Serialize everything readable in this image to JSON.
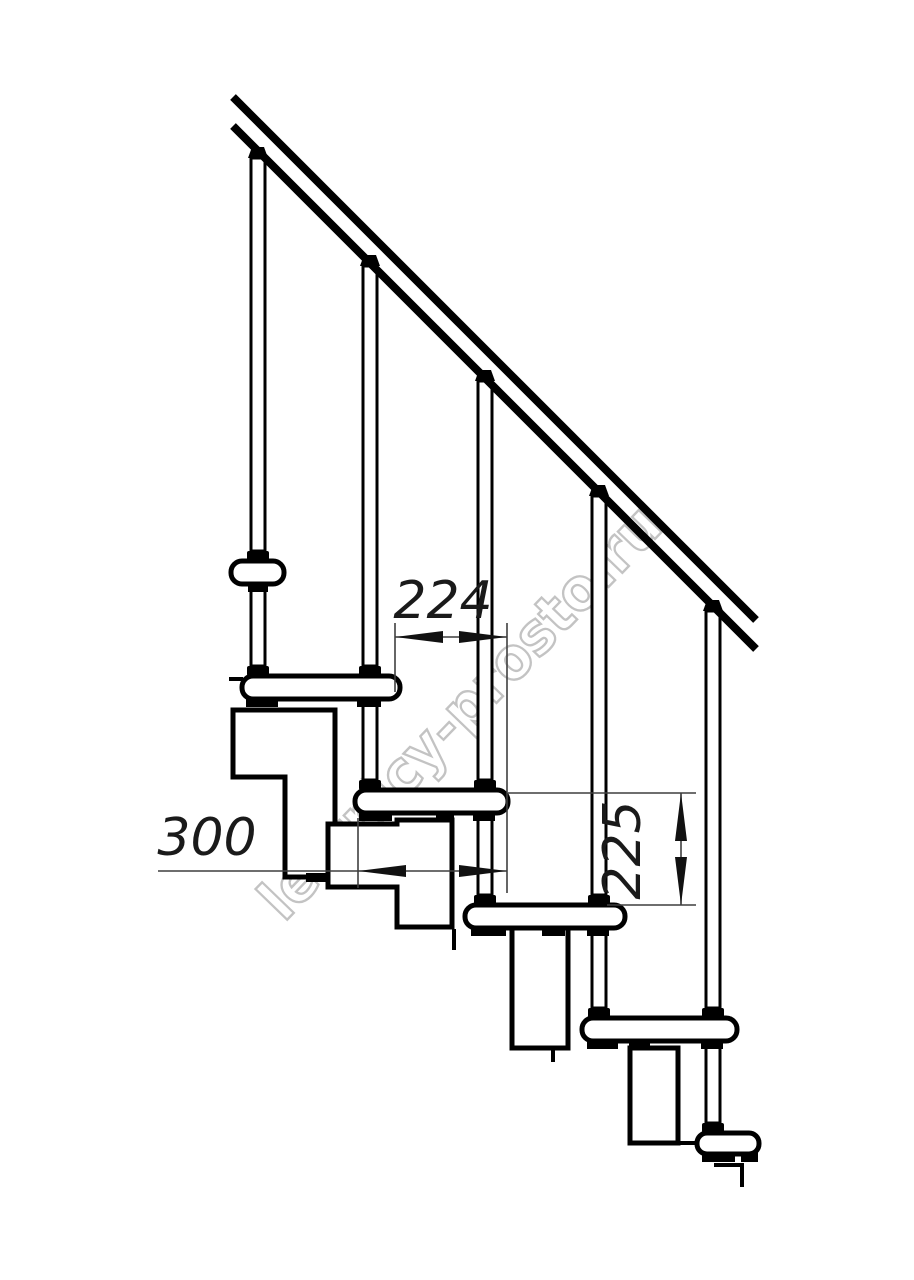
{
  "drawing": {
    "watermark": "lestnicy-prosto.ru",
    "dimensions": {
      "tread_overlap": "224",
      "tread_depth": "300",
      "step_height": "225"
    },
    "colors": {
      "line": "#000000",
      "dimension": "#3f3f3f",
      "watermark": "#bdbdbd",
      "background": "#ffffff"
    }
  }
}
